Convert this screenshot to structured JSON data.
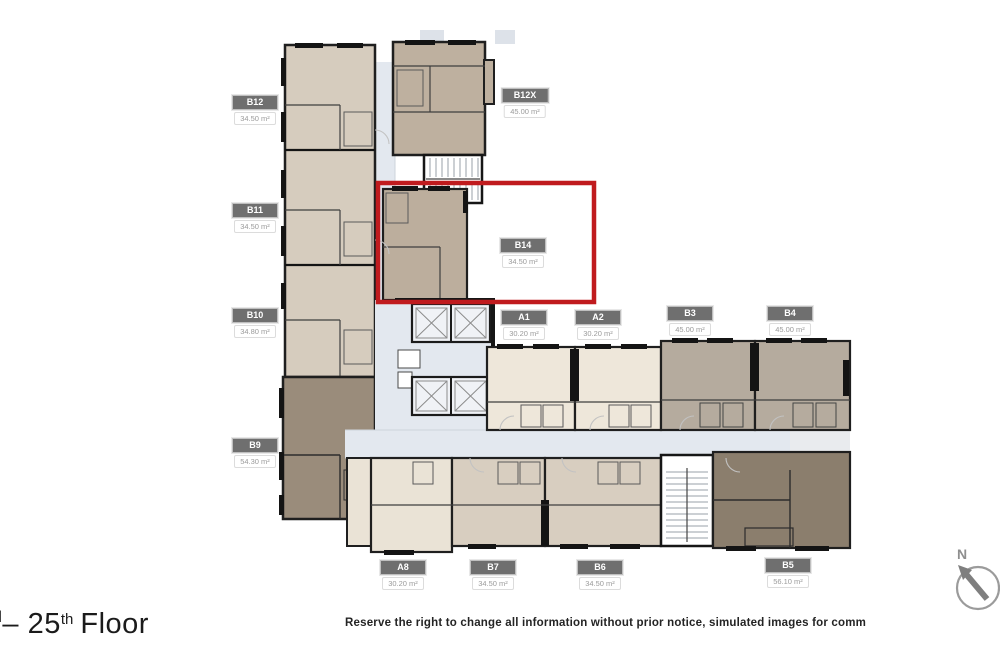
{
  "floor_plan": {
    "highlight_color": "#c01b1e",
    "highlighted_unit": "B14",
    "units": [
      {
        "id": "B12",
        "area": "34.50 m²"
      },
      {
        "id": "B11",
        "area": "34.50 m²"
      },
      {
        "id": "B10",
        "area": "34.80 m²"
      },
      {
        "id": "B9",
        "area": "54.30 m²"
      },
      {
        "id": "B12X",
        "area": "45.00 m²"
      },
      {
        "id": "B14",
        "area": "34.50 m²"
      },
      {
        "id": "A1",
        "area": "30.20 m²"
      },
      {
        "id": "A2",
        "area": "30.20 m²"
      },
      {
        "id": "B3",
        "area": "45.00 m²"
      },
      {
        "id": "B4",
        "area": "45.00 m²"
      },
      {
        "id": "A8",
        "area": "30.20 m²"
      },
      {
        "id": "B7",
        "area": "34.50 m²"
      },
      {
        "id": "B6",
        "area": "34.50 m²"
      },
      {
        "id": "B5",
        "area": "56.10 m²"
      }
    ],
    "compass": {
      "label": "N"
    }
  },
  "footer": {
    "floor_label": {
      "cut_fragment": "d",
      "number": "– 25",
      "ordinal": "th",
      "word": "Floor"
    },
    "disclaimer": "Reserve the right to change all information without prior notice, simulated images for comm"
  },
  "colors": {
    "accent_red": "#c01b1e",
    "label_header_bg": "#6f6f6f",
    "corridor": "#e3e8ef",
    "unit_beige": "#d6ccbe",
    "unit_taupe": "#beb09f",
    "unit_cream": "#eee7da",
    "unit_mauve": "#b5ab9e",
    "unit_dark_brown": "#8b7e6d"
  }
}
